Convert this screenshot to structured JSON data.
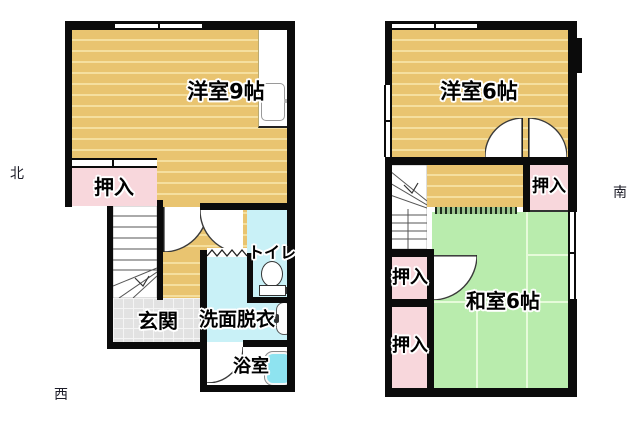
{
  "title": "floor-plan",
  "compass": {
    "north": "北",
    "west": "西",
    "south": "南"
  },
  "floor1": {
    "rooms": {
      "western_room": "洋室9帖",
      "closet": "押入",
      "entrance": "玄関",
      "washroom": "洗面脱衣",
      "toilet": "トイレ",
      "bathroom": "浴室"
    }
  },
  "floor2": {
    "rooms": {
      "western_room": "洋室6帖",
      "closet_ne": "押入",
      "closet_w_upper": "押入",
      "closet_w_lower": "押入",
      "japanese_room": "和室6帖"
    }
  },
  "colors": {
    "wall": "#0b0b0b",
    "wood_floor": "#e9c470",
    "wood_stripe": "#f5df9f",
    "closet_pink": "#f8d7dc",
    "water_cyan": "#c9f1f7",
    "tatami_green": "#b9ecad",
    "bathtub_cyan": "#8ee3f0",
    "entrance_tile": "#e2e2e2"
  },
  "icons": {
    "toilet": "toilet-icon",
    "bathtub": "bathtub-icon",
    "washbasin": "washbasin-icon",
    "stairs_first": "stairs-icon",
    "stairs_second": "stairs-icon"
  }
}
